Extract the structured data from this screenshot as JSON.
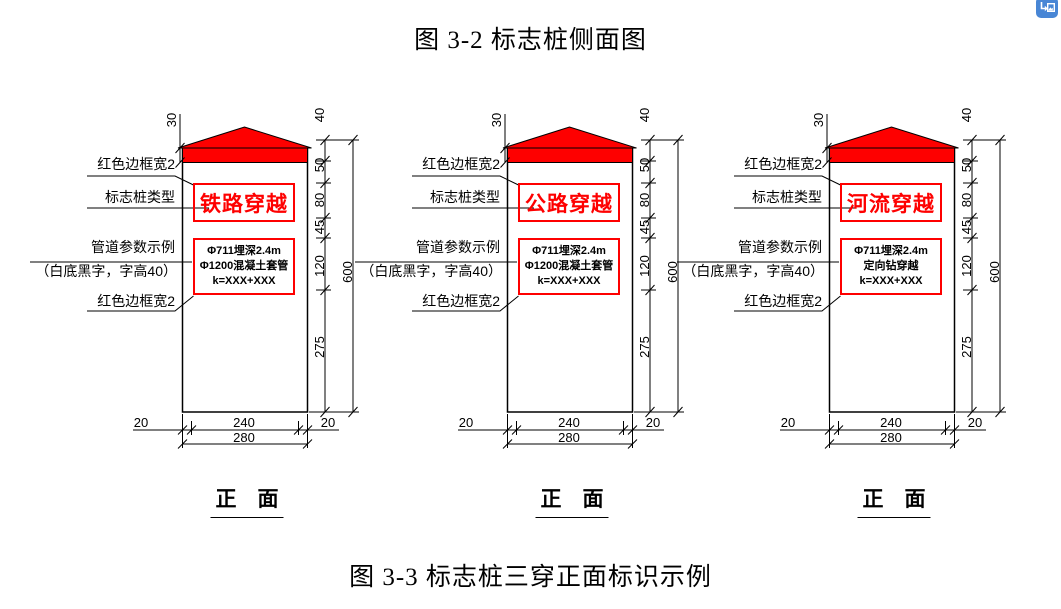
{
  "page": {
    "title_top": "图 3-2 标志桩侧面图",
    "title_bottom": "图 3-3 标志桩三穿正面标识示例",
    "view_label": "正　面"
  },
  "labels": {
    "red_border": "红色边框宽2",
    "post_type": "标志桩类型",
    "pipe_param": "管道参数示例",
    "param_note": "（白底黑字，字高40）"
  },
  "dims": {
    "cap": "30",
    "chain": [
      "40",
      "50",
      "80",
      "45",
      "120",
      "275"
    ],
    "total": "600",
    "bottom": [
      "20",
      "240",
      "20"
    ],
    "bottom_total": "280"
  },
  "diagrams": [
    {
      "type_text": "铁路穿越",
      "param_lines": [
        "Φ711埋深2.4m",
        "Φ1200混凝土套管",
        "k=XXX+XXX"
      ]
    },
    {
      "type_text": "公路穿越",
      "param_lines": [
        "Φ711埋深2.4m",
        "Φ1200混凝土套管",
        "k=XXX+XXX"
      ]
    },
    {
      "type_text": "河流穿越",
      "param_lines": [
        "Φ711埋深2.4m",
        "定向钻穿越",
        "k=XXX+XXX"
      ]
    }
  ],
  "corner_icon": {
    "name": "save-image-shortcut",
    "color": "#4886d5"
  },
  "colors": {
    "red": "#fe0000",
    "black": "#000000"
  }
}
